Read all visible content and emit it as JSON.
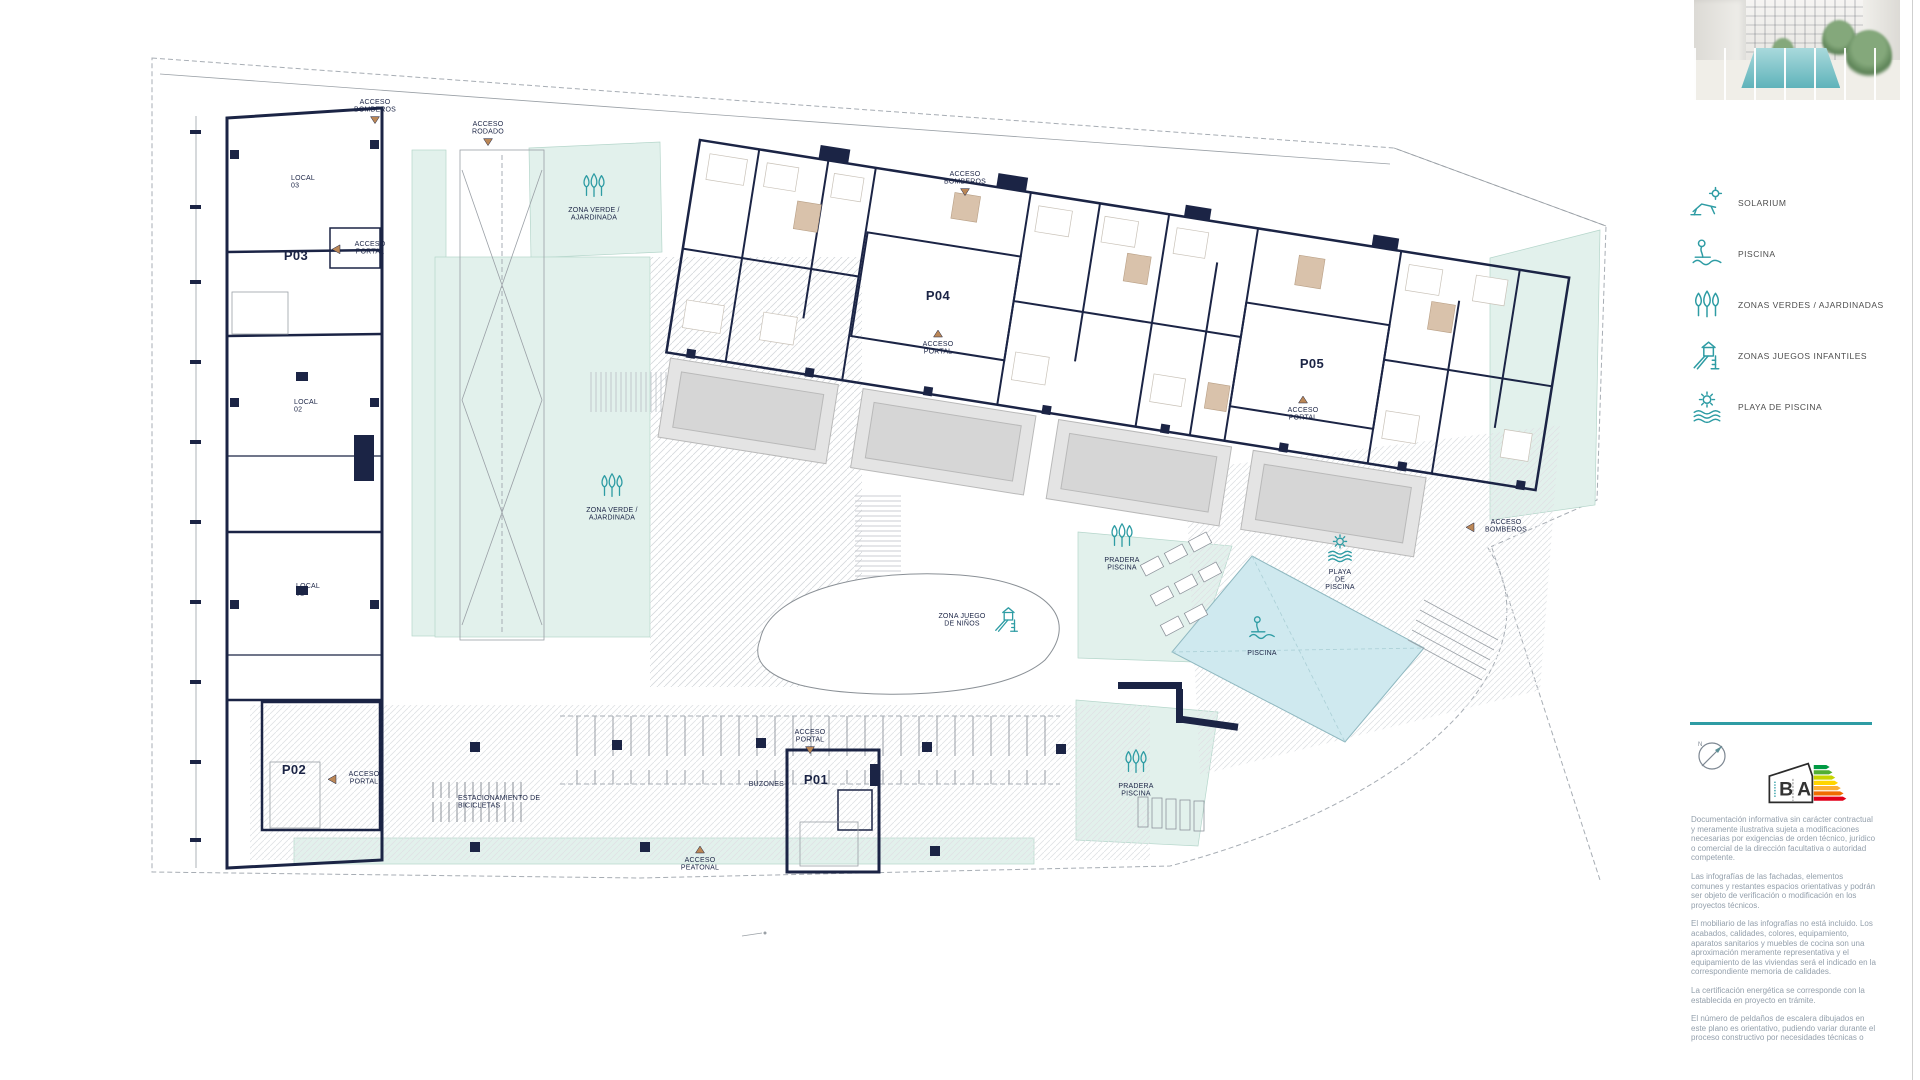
{
  "colors": {
    "wall_navy": "#1b2445",
    "apartment_beige": "#ead9c9",
    "apartment_tan": "#d9c2ab",
    "green_mint": "#e2f1ec",
    "pool_cyan": "#cfe9ef",
    "teal_accent": "#2e9ca4",
    "terrace_gray": "#e4e4e4",
    "arrow_tan": "#bb8756",
    "muted_text": "#94a0ac"
  },
  "legend": {
    "items": [
      {
        "icon": "solarium",
        "label": "SOLARIUM"
      },
      {
        "icon": "swimmer",
        "label": "PISCINA"
      },
      {
        "icon": "trees",
        "label": "ZONAS VERDES / AJARDINADAS"
      },
      {
        "icon": "slide",
        "label": "ZONAS JUEGOS INFANTILES"
      },
      {
        "icon": "sun-waves",
        "label": "PLAYA DE PISCINA"
      }
    ]
  },
  "certification": {
    "letter_left": "B",
    "letter_right": "A"
  },
  "disclaimer": {
    "paragraphs": [
      "Documentación informativa sin carácter contractual y meramente ilustrativa sujeta a modificaciones necesarias por exigencias de orden técnico, jurídico o comercial de la dirección facultativa o autoridad competente.",
      "Las infografías de las fachadas, elementos comunes y restantes espacios orientativas y podrán ser objeto de verificación o modificación en los proyectos técnicos.",
      "El mobiliario de las infografías no está incluido. Los acabados, calidades, colores, equipamiento, aparatos sanitarios y muebles de cocina son una aproximación meramente representativa y el equipamiento de las viviendas será el indicado en la correspondiente memoria de calidades.",
      "La certificación energética se corresponde con la establecida en proyecto en trámite.",
      "El número de peldaños de escalera dibujados en este plano es orientativo, pudiendo variar durante el proceso constructivo por necesidades técnicas o"
    ]
  },
  "plan": {
    "labels": [
      {
        "name": "acceso-bomberos-top-left",
        "lines": [
          "ACCESO",
          "BOMBEROS"
        ],
        "x": 375,
        "y": 104,
        "arrow": "down"
      },
      {
        "name": "acceso-rodado",
        "lines": [
          "ACCESO",
          "RODADO"
        ],
        "x": 488,
        "y": 126,
        "arrow": "down"
      },
      {
        "name": "acceso-bomberos-top-center",
        "lines": [
          "ACCESO",
          "BOMBEROS"
        ],
        "x": 965,
        "y": 176,
        "arrow": "down"
      },
      {
        "name": "zona-verde-top",
        "lines": [
          "ZONA VERDE /",
          "AJARDINADA"
        ],
        "x": 594,
        "y": 212,
        "icon": "trees"
      },
      {
        "name": "local-03",
        "lines": [
          "LOCAL",
          "03"
        ],
        "x": 291,
        "y": 180,
        "align": "start"
      },
      {
        "name": "p03",
        "lines": [
          "P03"
        ],
        "x": 296,
        "y": 260,
        "big": true
      },
      {
        "name": "acceso-portal-p03",
        "lines": [
          "ACCESO",
          "PORTAL"
        ],
        "x": 370,
        "y": 246,
        "arrow": "left",
        "maxw": 30
      },
      {
        "name": "p04",
        "lines": [
          "P04"
        ],
        "x": 938,
        "y": 300,
        "big": true
      },
      {
        "name": "acceso-portal-p04",
        "lines": [
          "ACCESO",
          "PORTAL"
        ],
        "x": 938,
        "y": 346,
        "arrow": "up"
      },
      {
        "name": "p05",
        "lines": [
          "P05"
        ],
        "x": 1312,
        "y": 368,
        "big": true
      },
      {
        "name": "acceso-portal-p05",
        "lines": [
          "ACCESO",
          "PORTAL"
        ],
        "x": 1303,
        "y": 412,
        "arrow": "up"
      },
      {
        "name": "local-02",
        "lines": [
          "LOCAL",
          "02"
        ],
        "x": 294,
        "y": 404,
        "align": "start"
      },
      {
        "name": "local-01",
        "lines": [
          "LOCAL",
          "01"
        ],
        "x": 296,
        "y": 588,
        "align": "start"
      },
      {
        "name": "zona-verde-center",
        "lines": [
          "ZONA VERDE /",
          "AJARDINADA"
        ],
        "x": 612,
        "y": 512,
        "icon": "trees"
      },
      {
        "name": "zona-juego-de-ninos",
        "lines": [
          "ZONA JUEGO",
          "DE NIÑOS"
        ],
        "x": 962,
        "y": 618,
        "icon": "slide",
        "iconDx": 30,
        "iconDy": -6
      },
      {
        "name": "pradera-piscina-top",
        "lines": [
          "PRADERA",
          "PISCINA"
        ],
        "x": 1122,
        "y": 562,
        "icon": "trees"
      },
      {
        "name": "playa-de-piscina",
        "lines": [
          "PLAYA",
          "DE",
          "PISCINA"
        ],
        "x": 1340,
        "y": 574,
        "icon": "sun-waves"
      },
      {
        "name": "piscina",
        "lines": [
          "PISCINA"
        ],
        "x": 1262,
        "y": 655,
        "icon": "swimmer"
      },
      {
        "name": "acceso-bomberos-right",
        "lines": [
          "ACCESO",
          "BOMBEROS"
        ],
        "x": 1506,
        "y": 524,
        "arrow": "left",
        "maxw": 32
      },
      {
        "name": "p02",
        "lines": [
          "P02"
        ],
        "x": 294,
        "y": 774,
        "big": true
      },
      {
        "name": "acceso-portal-p02",
        "lines": [
          "ACCESO",
          "PORTAL"
        ],
        "x": 364,
        "y": 776,
        "arrow": "left",
        "maxw": 28
      },
      {
        "name": "estacionamiento-bicicletas",
        "lines": [
          "ESTACIONAMIENTO DE",
          "BICICLETAS"
        ],
        "x": 458,
        "y": 800,
        "align": "start"
      },
      {
        "name": "buzones",
        "lines": [
          "BUZONES"
        ],
        "x": 784,
        "y": 786,
        "align": "end"
      },
      {
        "name": "acceso-portal-p01",
        "lines": [
          "ACCESO",
          "PORTAL"
        ],
        "x": 810,
        "y": 734,
        "arrow": "down"
      },
      {
        "name": "p01",
        "lines": [
          "P01"
        ],
        "x": 816,
        "y": 784,
        "big": true
      },
      {
        "name": "pradera-piscina-bottom",
        "lines": [
          "PRADERA",
          "PISCINA"
        ],
        "x": 1136,
        "y": 788,
        "icon": "trees"
      },
      {
        "name": "acceso-peatonal",
        "lines": [
          "ACCESO",
          "PEATONAL"
        ],
        "x": 700,
        "y": 862,
        "arrow": "up"
      }
    ]
  }
}
